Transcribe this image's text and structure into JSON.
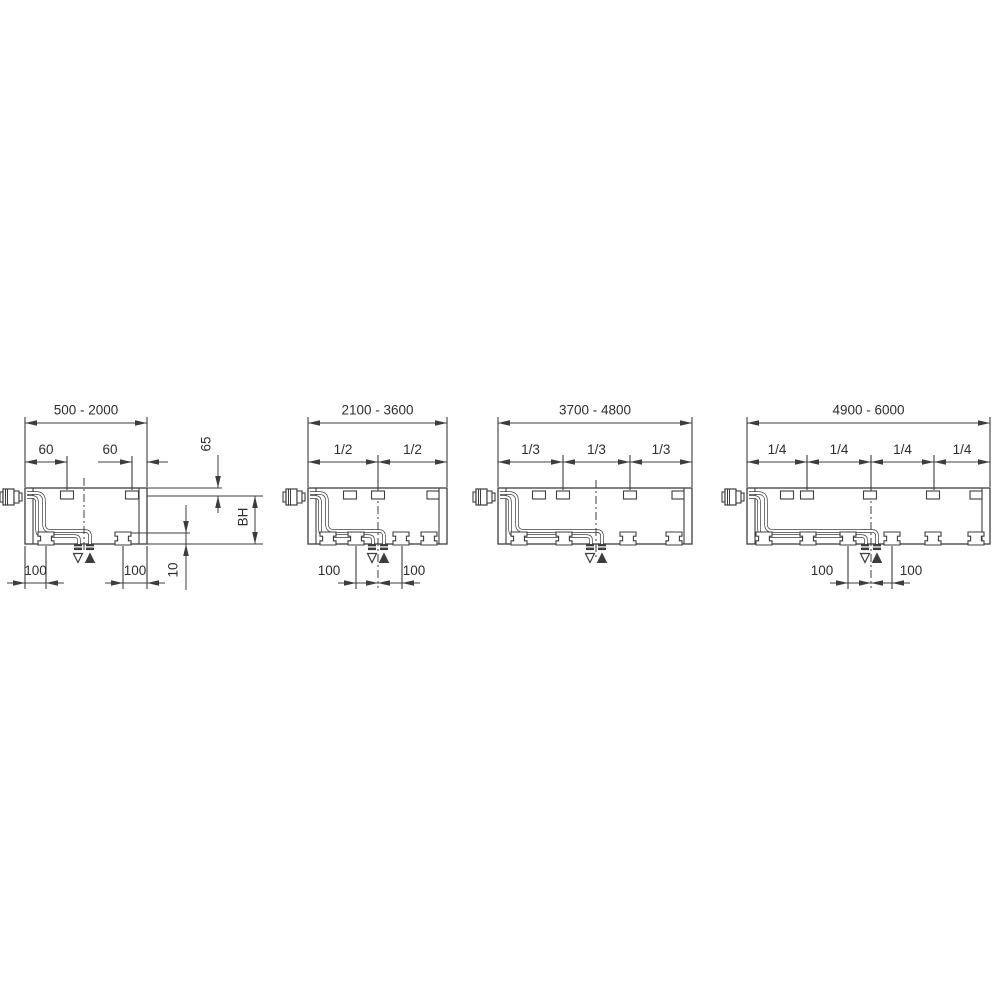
{
  "figure": {
    "title": "radiator-length-variant-dimension-drawing",
    "background": "#ffffff",
    "line_color": "#3d3d3d",
    "text_color": "#2e2e2e",
    "font_size": 13.5,
    "geometry": {
      "body_top": 488,
      "body_bottom": 544,
      "dim_top_y": 423,
      "dim_sub_y": 462,
      "dim_bottom_y": 583,
      "label_top_y": 411,
      "label_sub_y": 450.5,
      "label_bottom_y": 571.5
    },
    "symbols": {
      "return_symbol": "open-triangle-down",
      "flow_symbol": "filled-triangle-up"
    }
  },
  "diagrams": [
    {
      "id": "length-500-2000",
      "range_label": "500 - 2000",
      "body": {
        "left": 25,
        "right": 147
      },
      "brackets": [
        67,
        132
      ],
      "end_bracket": false,
      "feet": [
        46,
        123
      ],
      "center_x": 84,
      "centerline": [
        478,
        552
      ],
      "has_valve": true,
      "fractions": null,
      "sub_dims": [
        {
          "label": "60",
          "type": "inside",
          "from": 25,
          "to": 67,
          "label_x": 46,
          "ext": [
            67
          ]
        },
        {
          "label": "60",
          "type": "outside",
          "from": 132,
          "to": 147,
          "label_x": 110,
          "ext": [
            132
          ],
          "leader_left": [
            98,
            132
          ],
          "leader_right": [
            147,
            168
          ]
        }
      ],
      "bottom_dims": [
        {
          "label": "100",
          "from": 25,
          "to": 46,
          "label_x": 35.5
        },
        {
          "label": "100",
          "from": 123,
          "to": 147,
          "label_x": 135
        }
      ],
      "side_annotations": {
        "ref_lines": [
          [
            147,
            488,
            222,
            488
          ],
          [
            147,
            496,
            263,
            496
          ],
          [
            147,
            544,
            263,
            544
          ],
          [
            131,
            533,
            190,
            533
          ]
        ],
        "vdims": [
          {
            "label": "65",
            "x": 218,
            "label_pos": [
              207,
              444
            ],
            "segments": [
              [
                455,
                488
              ],
              [
                496,
                513
              ]
            ],
            "arrows": [
              {
                "tip": 488,
                "dir": "down"
              },
              {
                "tip": 496,
                "dir": "up"
              }
            ]
          },
          {
            "label": "BH",
            "x": 255,
            "label_pos": [
              244,
              517
            ],
            "segments": [
              [
                496,
                544
              ]
            ],
            "arrows": [
              {
                "tip": 496,
                "dir": "up"
              },
              {
                "tip": 544,
                "dir": "down"
              }
            ]
          },
          {
            "label": "10",
            "x": 186,
            "label_pos": [
              174,
              570
            ],
            "segments": [
              [
                505,
                590
              ]
            ],
            "arrows": [
              {
                "tip": 533,
                "dir": "down"
              },
              {
                "tip": 544,
                "dir": "up"
              }
            ]
          }
        ]
      }
    },
    {
      "id": "length-2100-3600",
      "range_label": "2100 - 3600",
      "body": {
        "left": 308,
        "right": 447
      },
      "brackets": [
        350,
        378
      ],
      "end_bracket": true,
      "feet": [
        328,
        356,
        401,
        429
      ],
      "center_x": 378,
      "centerline": [
        490,
        588
      ],
      "has_valve": true,
      "fractions": {
        "labels": [
          "1/2",
          "1/2"
        ],
        "ticks": [
          378
        ]
      },
      "sub_dims": null,
      "bottom_dims": [
        {
          "label": "100",
          "from": 356,
          "to": 378,
          "label_x": 329
        },
        {
          "label": "100",
          "from": 378,
          "to": 402,
          "label_x": 414
        }
      ],
      "side_annotations": null
    },
    {
      "id": "length-3700-4800",
      "range_label": "3700 - 4800",
      "body": {
        "left": 498,
        "right": 692
      },
      "brackets": [
        539,
        563,
        630
      ],
      "end_bracket": true,
      "feet": [
        519,
        564,
        628,
        674
      ],
      "center_x": 596,
      "centerline": [
        480,
        560
      ],
      "has_valve": true,
      "fractions": {
        "labels": [
          "1/3",
          "1/3",
          "1/3"
        ],
        "ticks": [
          563,
          630
        ]
      },
      "sub_dims": null,
      "bottom_dims": [],
      "side_annotations": null
    },
    {
      "id": "length-4900-6000",
      "range_label": "4900 - 6000",
      "body": {
        "left": 747,
        "right": 990
      },
      "brackets": [
        787,
        807,
        870,
        933
      ],
      "end_bracket": true,
      "feet": [
        764,
        808,
        848,
        892,
        933,
        976
      ],
      "center_x": 871,
      "centerline": [
        490,
        588
      ],
      "has_valve": true,
      "fractions": {
        "labels": [
          "1/4",
          "1/4",
          "1/4",
          "1/4"
        ],
        "ticks": [
          807,
          871,
          934
        ]
      },
      "sub_dims": null,
      "bottom_dims": [
        {
          "label": "100",
          "from": 848,
          "to": 871,
          "label_x": 822
        },
        {
          "label": "100",
          "from": 871,
          "to": 892,
          "label_x": 911
        }
      ],
      "side_annotations": null
    }
  ]
}
